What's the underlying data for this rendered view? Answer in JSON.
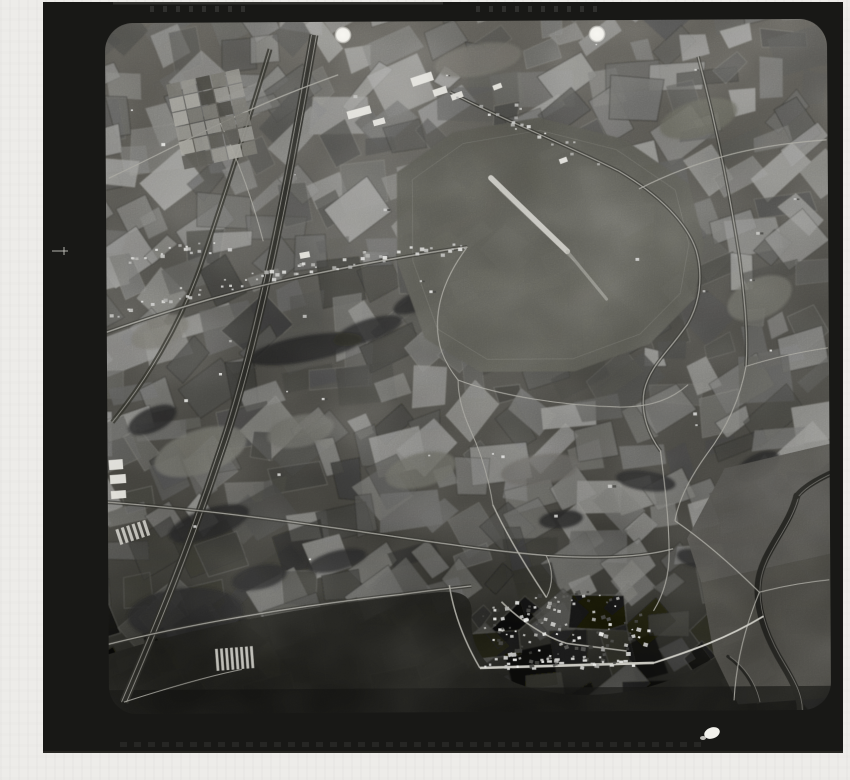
{
  "meta": {
    "description": "Scanned monochrome vertical aerial survey photograph of farmland, an airfield with runway, a railway corridor and a village, printed with a black film frame on a light backing sheet",
    "photo_kind": "black-and-white aerial reconnaissance frame"
  },
  "palette": {
    "page_bg": "#edece9",
    "frame": "#181816",
    "frame_edge_highlight": "#4a4a46",
    "base_top": "#585650",
    "base_mid": "#4b4a45",
    "base_low": "#23231f",
    "base_bottom": "#141412",
    "road_light": "#a3a29a",
    "road_bright": "#cbcac2",
    "casing_dark": "#2b2b27",
    "water_dark": "#1b1b18",
    "wood_dark": "#22221e",
    "building_bright": "#e4e3dc",
    "fiducial": "#f5f4ef"
  },
  "frame": {
    "x": 43,
    "y": 2,
    "w": 800,
    "h": 751
  },
  "content": {
    "x": 107,
    "y": 21,
    "w": 722,
    "h": 691,
    "radius": 28,
    "tilt_deg": -0.35
  },
  "mosaic": {
    "seed": 11,
    "cell": 34,
    "jitter": 13,
    "min_gray": 52,
    "max_gray": 148,
    "angle_base": -22,
    "angle_var": 26
  },
  "airfield": {
    "outline": "M398,172 L455,132 L540,118 L625,140 L690,185 L705,245 L695,300 L650,345 L575,372 L480,372 L425,338 L398,262 Z",
    "fill": "#55544e",
    "runway": {
      "x1": 492,
      "y1": 178,
      "x2": 568,
      "y2": 252,
      "width": 5.5
    },
    "runway_ext": {
      "x1": 568,
      "y1": 252,
      "x2": 607,
      "y2": 300,
      "width": 3
    },
    "runway_shadow": {
      "x1": 500,
      "y1": 190,
      "x2": 575,
      "y2": 262,
      "width": 1.2
    }
  },
  "railway": {
    "path": "M316,34 C295,150 262,330 222,445 C185,555 152,630 122,700",
    "band_width": 9
  },
  "tree_road": {
    "path": "M272,48 C250,120 225,195 202,262 C180,325 145,380 112,420"
  },
  "roads": [
    {
      "path": "M107,330 C170,308 240,288 310,274 C370,262 430,252 468,247",
      "w": 1.4,
      "casing": true
    },
    {
      "path": "M452,92 C500,118 560,142 620,172 C660,196 688,224 697,252 C704,278 700,305 688,325 C670,352 650,366 644,392 C640,414 648,436 660,452",
      "w": 1.2,
      "casing": true
    },
    {
      "path": "M468,247 C452,268 440,292 438,318 C436,344 444,362 458,380",
      "w": 1.1,
      "casing": false
    },
    {
      "path": "M458,380 C500,396 560,406 620,408 C652,408 672,400 688,386",
      "w": 1.1,
      "casing": false
    },
    {
      "path": "M107,500 C180,506 260,516 340,528 C420,540 480,550 545,556 C600,560 642,558 672,550",
      "w": 1.3,
      "casing": true
    },
    {
      "path": "M107,642 C190,622 300,604 400,594 C430,590 452,588 470,586",
      "w": 1.3,
      "casing": true
    },
    {
      "path": "M492,505 C488,478 480,452 470,430 C462,412 458,396 458,380",
      "w": 1.0,
      "casing": false
    },
    {
      "path": "M700,58 C716,120 730,190 740,258 C746,308 748,340 746,368",
      "w": 1.2,
      "casing": true
    },
    {
      "path": "M746,368 C740,400 726,430 706,456 C690,478 678,500 674,522",
      "w": 1.1,
      "casing": false
    },
    {
      "path": "M340,74 C300,88 260,104 222,122 C180,142 145,160 110,176",
      "w": 1.2,
      "casing": false
    },
    {
      "path": "M674,522 C700,540 730,566 758,594",
      "w": 1.2,
      "casing": false
    },
    {
      "path": "M758,594 C742,632 734,668 732,702",
      "w": 1.1,
      "casing": false
    },
    {
      "path": "M758,594 C782,588 806,584 828,582",
      "w": 1.1,
      "casing": false
    },
    {
      "path": "M545,556 C552,570 552,584 545,598",
      "w": 1.0,
      "casing": false
    },
    {
      "path": "M222,122 C240,160 254,200 264,240",
      "w": 1.0,
      "casing": false
    },
    {
      "path": "M640,190 C668,176 700,164 732,156 C764,148 798,144 828,142",
      "w": 1.2,
      "casing": false
    },
    {
      "path": "M746,368 C772,360 800,354 828,350",
      "w": 1.0,
      "casing": false
    },
    {
      "path": "M660,452 C664,486 668,520 668,554 C668,576 662,596 652,612",
      "w": 1.1,
      "casing": false
    },
    {
      "path": "M122,700 C160,688 200,676 240,668",
      "w": 1.0,
      "casing": false
    }
  ],
  "woods": [
    {
      "cx": 305,
      "cy": 348,
      "rx": 58,
      "ry": 13,
      "rot": -10
    },
    {
      "cx": 368,
      "cy": 330,
      "rx": 36,
      "ry": 11,
      "rot": -18
    },
    {
      "cx": 420,
      "cy": 300,
      "rx": 28,
      "ry": 10,
      "rot": -22
    },
    {
      "cx": 208,
      "cy": 522,
      "rx": 42,
      "ry": 15,
      "rot": -18
    },
    {
      "cx": 184,
      "cy": 612,
      "rx": 58,
      "ry": 26,
      "rot": -4
    },
    {
      "cx": 258,
      "cy": 576,
      "rx": 28,
      "ry": 12,
      "rot": -12
    },
    {
      "cx": 645,
      "cy": 482,
      "rx": 30,
      "ry": 10,
      "rot": 8
    },
    {
      "cx": 757,
      "cy": 468,
      "rx": 24,
      "ry": 12,
      "rot": -28
    },
    {
      "cx": 560,
      "cy": 520,
      "rx": 22,
      "ry": 9,
      "rot": -6
    },
    {
      "cx": 336,
      "cy": 560,
      "rx": 30,
      "ry": 10,
      "rot": -14
    },
    {
      "cx": 152,
      "cy": 418,
      "rx": 26,
      "ry": 12,
      "rot": -24
    },
    {
      "cx": 695,
      "cy": 560,
      "rx": 20,
      "ry": 9,
      "rot": 14
    },
    {
      "cx": 352,
      "cy": 642,
      "rx": 58,
      "ry": 16,
      "rot": -5
    }
  ],
  "pale_fields": [
    {
      "cx": 200,
      "cy": 450,
      "rx": 48,
      "ry": 22,
      "rot": -18,
      "fill": "#6c6b64"
    },
    {
      "cx": 300,
      "cy": 430,
      "rx": 34,
      "ry": 16,
      "rot": -12,
      "fill": "#63625c"
    },
    {
      "cx": 160,
      "cy": 330,
      "rx": 30,
      "ry": 15,
      "rot": -20,
      "fill": "#6e6d66"
    },
    {
      "cx": 540,
      "cy": 470,
      "rx": 40,
      "ry": 15,
      "rot": -8,
      "fill": "#5e5d57"
    },
    {
      "cx": 420,
      "cy": 470,
      "rx": 36,
      "ry": 17,
      "rot": -14,
      "fill": "#606057"
    },
    {
      "cx": 760,
      "cy": 300,
      "rx": 34,
      "ry": 20,
      "rot": -24,
      "fill": "#67665f"
    },
    {
      "cx": 700,
      "cy": 120,
      "rx": 40,
      "ry": 18,
      "rot": -16,
      "fill": "#626158"
    },
    {
      "cx": 480,
      "cy": 60,
      "rx": 44,
      "ry": 16,
      "rot": -10,
      "fill": "#6a6962"
    }
  ],
  "lowland": {
    "path": "M107,652 C210,620 336,601 436,592 C462,590 472,596 470,618 C468,648 486,672 516,684 C570,704 644,698 696,668 C714,658 728,654 740,656 L746,712 L107,712 Z",
    "bottom_band": {
      "x": 107,
      "y": 688,
      "w": 722,
      "h": 24
    }
  },
  "right_fields": [
    {
      "points": "700,584 829,556 829,700 736,706 712,656",
      "fill": "#403f3a"
    },
    {
      "points": "724,470 829,446 829,556 700,584 686,540",
      "fill": "#4a4944"
    }
  ],
  "rivers": [
    {
      "path": "M796,498 C788,530 760,555 757,585 C754,615 768,645 782,668 C792,685 800,700 798,718",
      "w": 7
    },
    {
      "path": "M843,470 C823,478 804,488 796,498",
      "w": 6
    },
    {
      "path": "M726,658 C740,668 752,684 756,704",
      "w": 3
    }
  ],
  "village": {
    "cx": 562,
    "cy": 630,
    "rx": 88,
    "ry": 40,
    "count": 135,
    "seed": 5,
    "streets": [
      {
        "path": "M478,668 L652,664",
        "w": 2.6,
        "bright": true
      },
      {
        "path": "M500,602 C520,622 545,638 565,644",
        "w": 1.6,
        "bright": false
      },
      {
        "path": "M565,644 L625,652",
        "w": 1.4,
        "bright": false
      },
      {
        "path": "M652,664 C690,652 725,640 762,618",
        "w": 1.8,
        "bright": true
      },
      {
        "path": "M545,598 C528,572 508,540 492,505",
        "w": 1.5,
        "bright": false
      },
      {
        "path": "M478,668 C462,640 452,612 448,585",
        "w": 1.5,
        "bright": false
      }
    ]
  },
  "ribbon_settlements": [
    {
      "path": "M108,316 C160,298 220,280 300,268 C360,258 420,252 468,248",
      "count": 62,
      "seed": 3,
      "spread": 7
    },
    {
      "path": "M130,258 C170,250 205,246 232,244",
      "count": 20,
      "seed": 8,
      "spread": 6
    },
    {
      "path": "M452,92 C500,118 556,140 612,166",
      "count": 18,
      "seed": 14,
      "spread": 6
    }
  ],
  "allotments": {
    "x": 176,
    "y": 74,
    "w": 76,
    "h": 88,
    "rows": 6,
    "cols": 5,
    "rot": -12
  },
  "greenhouse_strips": [
    {
      "x": 214,
      "y": 646,
      "w": 40,
      "h": 22,
      "stripes": 8,
      "rot": -4
    },
    {
      "x": 116,
      "y": 522,
      "w": 34,
      "h": 16,
      "stripes": 6,
      "rot": -18
    }
  ],
  "bright_sites": [
    {
      "x": 412,
      "y": 78,
      "w": 22,
      "h": 9,
      "rot": -18
    },
    {
      "x": 434,
      "y": 90,
      "w": 14,
      "h": 7,
      "rot": -18
    },
    {
      "x": 452,
      "y": 95,
      "w": 12,
      "h": 6,
      "rot": -20
    },
    {
      "x": 348,
      "y": 111,
      "w": 24,
      "h": 8,
      "rot": -15
    },
    {
      "x": 374,
      "y": 120,
      "w": 12,
      "h": 6,
      "rot": -15
    },
    {
      "x": 494,
      "y": 86,
      "w": 9,
      "h": 5,
      "rot": -20
    },
    {
      "x": 108,
      "y": 458,
      "w": 14,
      "h": 10,
      "rot": -4
    },
    {
      "x": 109,
      "y": 473,
      "w": 16,
      "h": 9,
      "rot": -4
    },
    {
      "x": 110,
      "y": 489,
      "w": 15,
      "h": 8,
      "rot": -4
    },
    {
      "x": 560,
      "y": 160,
      "w": 8,
      "h": 5,
      "rot": -20
    },
    {
      "x": 300,
      "y": 252,
      "w": 10,
      "h": 6,
      "rot": -10
    }
  ],
  "farm_dots": {
    "seed": 21,
    "count": 48
  },
  "fiducials": [
    {
      "cx": 343,
      "cy": 35,
      "r": 8.5
    },
    {
      "cx": 597,
      "cy": 34,
      "r": 8.5
    }
  ],
  "edge_cross": {
    "x": 62,
    "y": 251
  },
  "blob": {
    "cx": 712,
    "cy": 733,
    "rx": 8,
    "ry": 5.5,
    "rot": -20
  },
  "bottom_ticks": {
    "y": 742,
    "x0": 120,
    "x1": 700,
    "step": 14
  },
  "top_edge_marks": {
    "y": 6,
    "step": 13,
    "groups": [
      {
        "x0": 150,
        "n": 8
      },
      {
        "x0": 476,
        "n": 10
      }
    ]
  }
}
